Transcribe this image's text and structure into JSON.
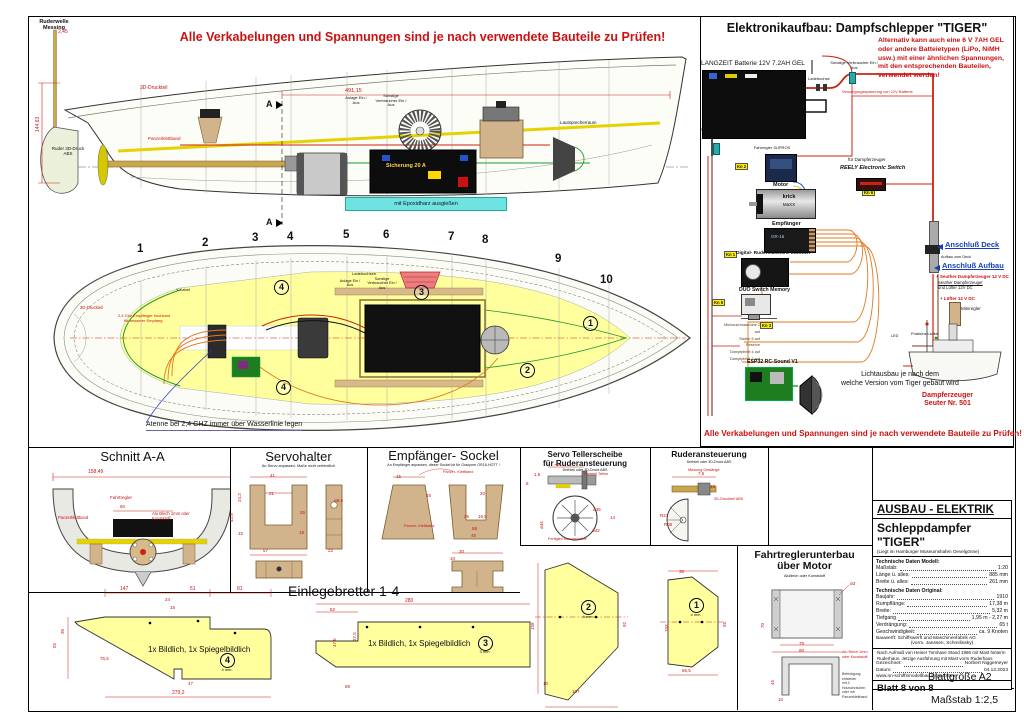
{
  "colors": {
    "warning_red": "#cc1111",
    "blue_label": "#1540bb",
    "deck_yellow": "#ffff9e",
    "wood_tan": "#d2b48c",
    "wire_orange": "#e07b20",
    "wire_green": "#1a9a30",
    "wire_red": "#cc2211",
    "battery_black": "#0d0d0d"
  },
  "warnings": {
    "top": "Alle Verkabelungen und Spannungen sind je nach verwendete Bauteile zu Prüfen!",
    "panel_bottom": "Alle Verkabelungen und Spannungen sind je nach verwendete Bauteile zu Prüfen!"
  },
  "profile": {
    "ruderwelle": "Ruderwelle Messing",
    "dim_245": "2,45",
    "dim_14463": "144,63",
    "dim_49115": "491,15",
    "druckteil": "3D-Druckteil",
    "ruder": "Ruder 3D-Druck ABS",
    "sicherung": "Sicherung 20 A",
    "epoxid": "mit Epoxidharz ausgießen",
    "panzerklettband": "Panzerklettband",
    "lautsprecherraum": "Lautsprecherraum",
    "anlage": "Anlage Ein / Aus",
    "verbraucher": "Sonstige Verbraucher Ein / Aus",
    "section_marker": "A"
  },
  "deck": {
    "frames": [
      "1",
      "2",
      "3",
      "4",
      "5",
      "6",
      "7",
      "8",
      "9",
      "10"
    ],
    "circles": [
      "1",
      "2",
      "3",
      "4"
    ],
    "y_kabel": "Y-Kabel",
    "druckteil": "3D-Druckteil",
    "empf_note1": "2,4 Ghz Empfänger hochkant",
    "empf_note2": "für besserer Empfang",
    "ladebuchsen": "Ladebuchsen",
    "anlage": "Anlage Ein / Aus",
    "verbraucher": "Sonstige Verbraucher Ein / Aus",
    "antenne": "Atenne bei 2,4 GHZ immer über Wasserlinie legen"
  },
  "electronics": {
    "title": "Elektronikaufbau: Dampfschlepper \"TIGER\"",
    "battery": "LANGZEIT Batterie 12V 7.2AH GEL",
    "alt1": "Alternativ kann auch eine 6 V 7AH GEL",
    "alt2": "oder andere Batteietypen (LiPo, NiMH",
    "alt3": "usw.) mit einer ähnlichen Spannungen,",
    "alt4": "mit den entsprechenden Bauteilen,",
    "alt5": "verwendet werden!",
    "verbraucher": "Sonstige Verbraucher Ein / Aus",
    "ladebuchse": "Ladebuchse",
    "anlage": "Anlage Ein / Aus",
    "versorgung": "Versorgungsspannung von 12V Batterie",
    "fahrregler": "Fahrregler SUPROS",
    "motor": "Motor",
    "motor_brand": "krick",
    "motor_type": "MaXX",
    "reely1": "für Dampferzeuger",
    "reely2": "REELY Electronic Switch",
    "empfaenger": "Empfänger",
    "empf_display": "GR-16",
    "rudermaschine": "Digital- Rudermaschine MG996R",
    "duo": "DUO Switch Memory",
    "esp": "ESP32 RC-Sound V1",
    "anschluss_deck": "Anschluß Deck",
    "anschluss_aufbau": "Anschluß Aufbau",
    "aufbau_zum_deck": "Aufbau zum Deck",
    "seuther1": "+ Seuther Dampferzeuger 12 V DC",
    "seuther2": "Seuther Dampferzeuger",
    "seuther3": "und Lüfter 12V DC",
    "luefter": "+ Lüfter 12 V DC",
    "miniregler": "Miniregler",
    "led": "LED",
    "positions": "Positions Lichter",
    "dampferzeuger1": "Dampferzeuger",
    "dampferzeuger2": "Seuter Nr. 501",
    "licht1": "Lichtausbau je nach dem",
    "licht2": "welche Version vom Tiger gebaut wird",
    "tags": [
      "Kn 2",
      "Kn 6",
      "Kn 1",
      "Kn 5",
      "Kn 3"
    ],
    "wire_labels": [
      "Minirauchmaschine 2 auf",
      "Starter 5 auf",
      "Reserve",
      "Dampfpfeife 4 auf",
      "Dampfpfeife 2 auf"
    ]
  },
  "sections": {
    "schnitt": {
      "title": "Schnitt A-A",
      "d15849": "158,49",
      "d60": "60",
      "fahrtregler": "Fahrtregler",
      "panzer": "Panzerklettband",
      "alu": "Alu Blech 1mm oder Kunststoff"
    },
    "servohalter": {
      "title": "Servohalter",
      "note": "An Servo anpassen. Maße nicht verbindlich",
      "d41": "41",
      "d21": "21",
      "d243": "24,3",
      "d425": "42,5",
      "d25": "25",
      "d18": "18",
      "d15": "15",
      "d57": "57",
      "d22": "22",
      "d85": "ø8,5"
    },
    "sockel": {
      "title": "Empfänger- Sockel",
      "note": "An Empfänger anpassen, dieser Sockel ist für Graupner GR16-HOTT !",
      "klett1": "Panzer- Klettband",
      "klett2": "Panzer- Klettband",
      "d15": "15",
      "d45": "45",
      "d20": "20",
      "d25": "25",
      "d165": "16,5",
      "d58": "58",
      "d45b": "45",
      "d30": "30",
      "d10": "10"
    },
    "teller": {
      "title1": "Servo Tellerscheibe",
      "title2": "für Ruderansteuerung",
      "note": "Drehteil oder 3D-Druck ABS",
      "d34": "~34",
      "teflon": "Drehteil Teflon",
      "d15": "1,5",
      "d8": "8",
      "d36": "ø36",
      "d44": "ø44",
      "d42": "ø42",
      "d14": "14",
      "fertig": "Fertigteil Servoscheibe"
    },
    "ruderansteuerung": {
      "title": "Ruderansteuerung",
      "note": "Drehteil oder 3D-Druck ABS",
      "messing": "Messing Gestänge",
      "druckteil": "3D-Druckteil ABS",
      "r23": "R23",
      "r35": "R35",
      "d75": "7,5",
      "d15": "15"
    },
    "fahrtreglerunterbau": {
      "title1": "Fahrtreglerunterbau",
      "title2": "über Motor",
      "note": "Alublech oder Kunststoff",
      "d70": "70",
      "d78": "78",
      "d80": "80",
      "d45": "45",
      "d10": "10",
      "d3": "ø3",
      "alu1": "Alu Blech 1mm",
      "alu2": "oder Kunststoff",
      "bef1": "Befestigung entweder",
      "bef2": "mit 4 Holzschrauben",
      "bef3": "oder mit",
      "bef4": "Panzerklettband"
    },
    "einlegebretter": {
      "title": "Einlegebretter 1-4",
      "mirror": "1x Bildlich, 1x Spiegelbildlich",
      "b4": {
        "no": "4",
        "thick": "4 mm",
        "d147": "147",
        "d51": "51",
        "d81": "81",
        "d24": "24",
        "d15": "15",
        "d765": "76,5",
        "d47": "47",
        "d2792": "279,2",
        "d55": "55",
        "d30": "30"
      },
      "b3": {
        "no": "3",
        "thick": "3 mm",
        "d280": "280",
        "d62": "62",
        "d275": "27,5",
        "d475": "47,5",
        "d69": "69"
      },
      "b2": {
        "no": "2",
        "thick": "4 mm",
        "d158": "158",
        "d107": "107",
        "d10": "10",
        "d92": "92"
      },
      "b1": {
        "no": "1",
        "thick": "4 mm",
        "d38": "38",
        "d103": "103",
        "d55": "55",
        "d665": "66,5"
      }
    }
  },
  "title_block": {
    "header": "AUSBAU - ELEKTRIK",
    "ship": "Schleppdampfer \"TIGER\"",
    "sub": "(Liegt im Hamburger Museumshafen Oevelgönne)",
    "model_head": "Technische Daten Modell:",
    "model_rows": [
      {
        "label": "Maßstab:",
        "value": "1:20"
      },
      {
        "label": "Länge ü. alles:",
        "value": "885 mm"
      },
      {
        "label": "Breite ü. alles:",
        "value": "261 mm"
      }
    ],
    "orig_head": "Technische Daten Original:",
    "orig_rows": [
      {
        "label": "Baujahr:",
        "value": "1910"
      },
      {
        "label": "Rumpflänge:",
        "value": "17,38 m"
      },
      {
        "label": "Breite:",
        "value": "5,32 m"
      },
      {
        "label": "Tiefgang",
        "value": "1,95 m - 2,27 m"
      },
      {
        "label": "Verdrängung:",
        "value": "65 t"
      },
      {
        "label": "Geschwindigkeit:",
        "value": "ca. 9 Knoten"
      }
    ],
    "bauwerft1": "Bauwerft: Schiffswerft und Maschinenfabrik AG",
    "bauwerft2": "(vorm. Janssen, Schmilinsky)",
    "note": "Nach Aufmaß von Heiner Tomhave Stand 1986 mit Mast hinterm Ruderhaus. Jetzige Ausführung mit Mast vorm Ruderhaus",
    "gezeichnet_label": "Gezeichnet:",
    "gezeichnet": "Norbert Niggemeyer",
    "datum_label": "Datum:",
    "datum": "04.12.2023",
    "web": "www.nn-schiffsmodellbau.page4.com",
    "blatt": "Blatt 8 von 8"
  },
  "footer": {
    "size": "Blattgröße A2",
    "scale": "Maßstab 1:2,5"
  }
}
